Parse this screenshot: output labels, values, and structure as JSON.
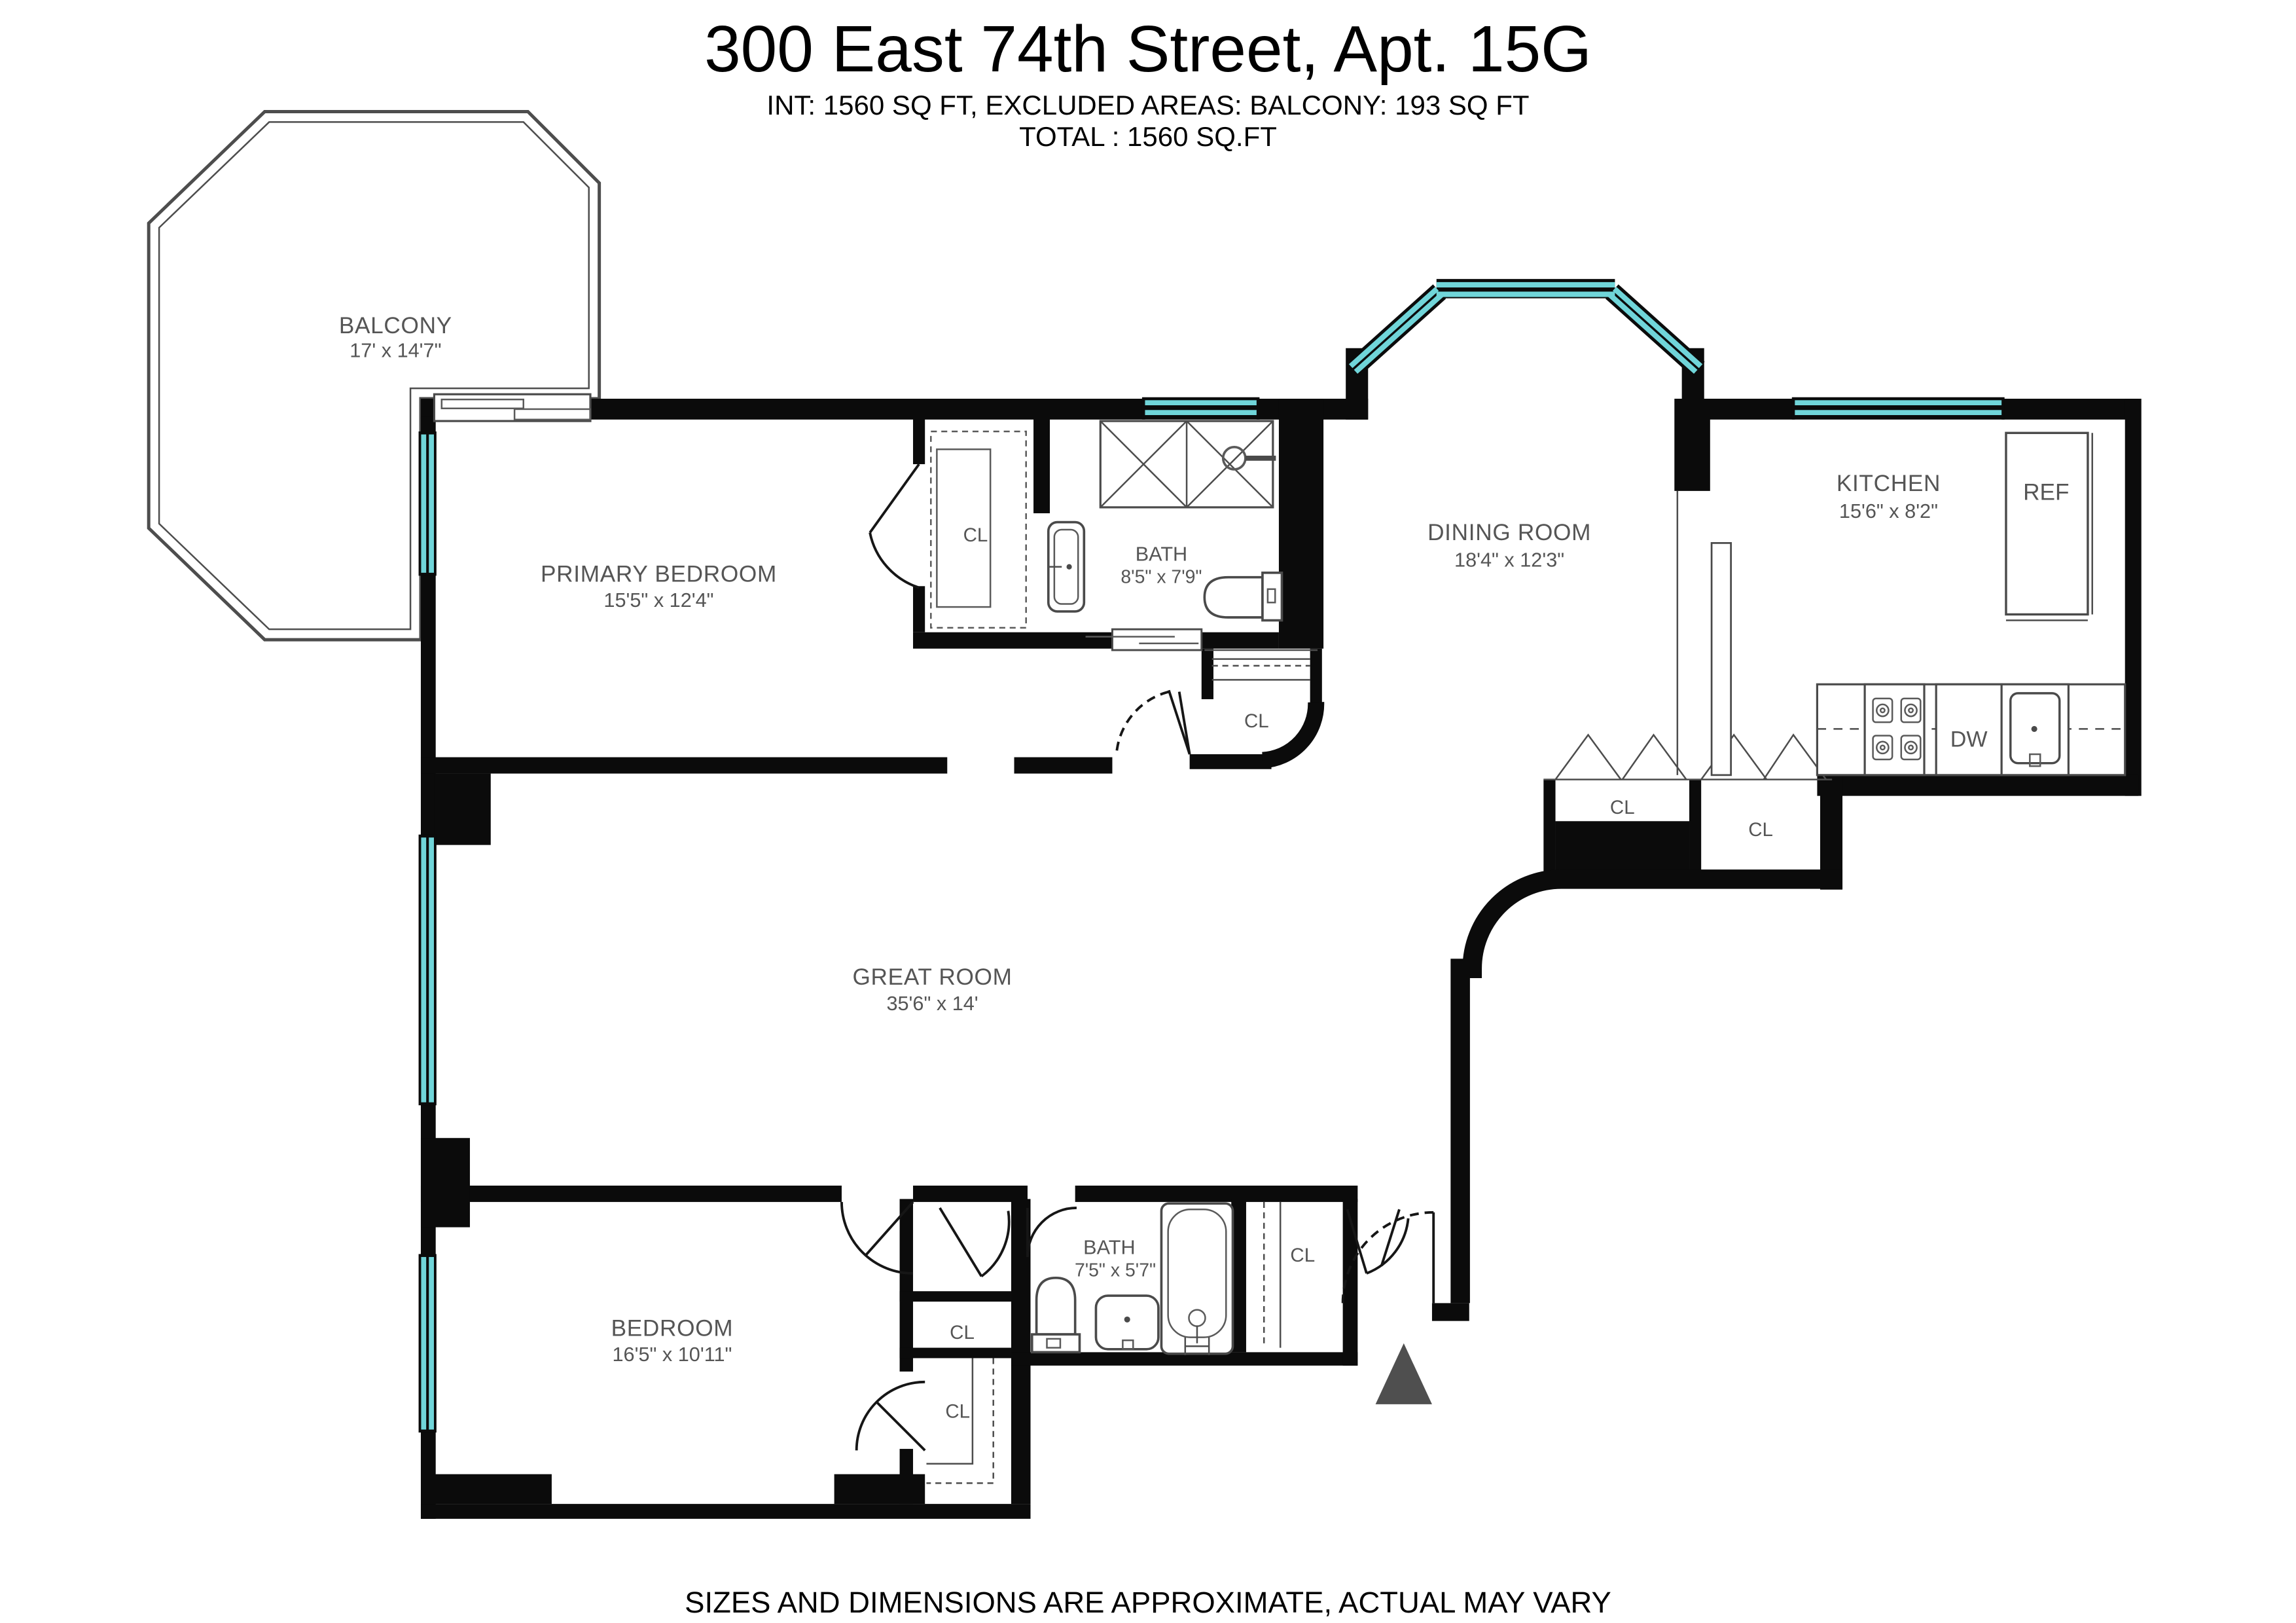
{
  "title": "300 East 74th Street, Apt. 15G",
  "subtitle_line1": "INT: 1560 SQ FT, EXCLUDED AREAS: BALCONY: 193 SQ FT",
  "subtitle_line2": "TOTAL : 1560 SQ.FT",
  "disclaimer": "SIZES AND DIMENSIONS ARE APPROXIMATE, ACTUAL MAY VARY",
  "rooms": {
    "balcony": {
      "name": "BALCONY",
      "dims": "17' x 14'7\""
    },
    "primary_bedroom": {
      "name": "PRIMARY BEDROOM",
      "dims": "15'5\" x 12'4\""
    },
    "bath_primary": {
      "name": "BATH",
      "dims": "8'5\" x 7'9\""
    },
    "dining_room": {
      "name": "DINING ROOM",
      "dims": "18'4\" x 12'3\""
    },
    "kitchen": {
      "name": "KITCHEN",
      "dims": "15'6\" x 8'2\""
    },
    "great_room": {
      "name": "GREAT ROOM",
      "dims": "35'6\" x 14'"
    },
    "bedroom": {
      "name": "BEDROOM",
      "dims": "16'5\" x 10'11\""
    },
    "bath_second": {
      "name": "BATH",
      "dims": "7'5\" x 5'7\""
    }
  },
  "labels": {
    "closet": "CL",
    "refrigerator": "REF",
    "dishwasher": "DW"
  },
  "colors": {
    "wall": "#0b0b0b",
    "window": "#70d5d9",
    "line_gray": "#4d4d4d",
    "label_gray": "#555555",
    "arrow_gray": "#4f4f4f"
  }
}
